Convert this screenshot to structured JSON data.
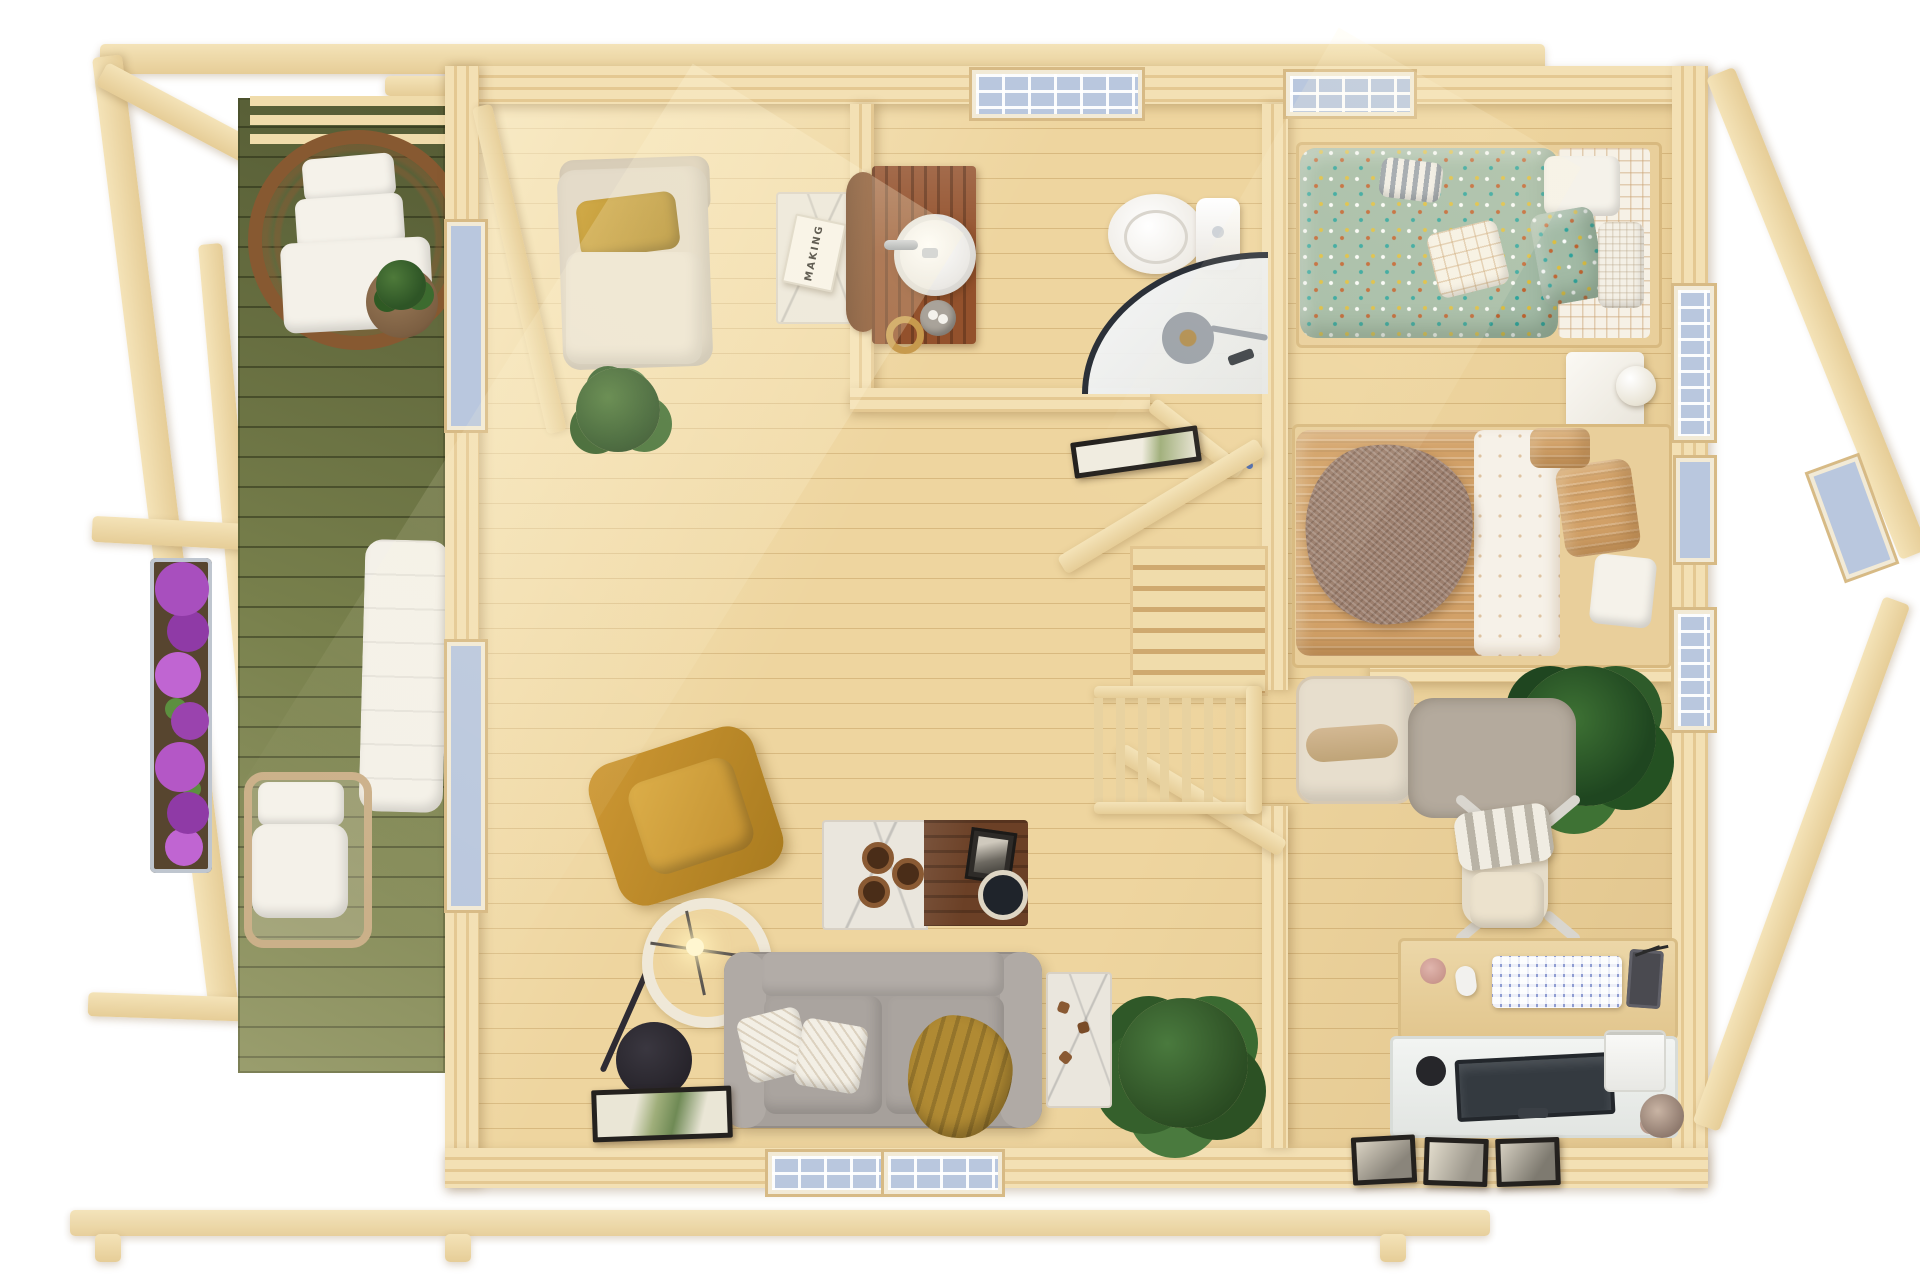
{
  "meta": {
    "title": "Log cabin with terrace — top-down 3D dollhouse floor plan render",
    "view": "top-down cutaway, roof removed",
    "floors_shown": 1
  },
  "palette": {
    "wood_beam": "#f4e3b8",
    "wood_wall": "#eed7a8",
    "floor": "#eed59f",
    "floor_line": "#dcba82",
    "deck_green": "#78804c",
    "walnut": "#6b4026",
    "vanity_wood": "#93512c",
    "sage": "#a3bba6",
    "caramel": "#d2a168",
    "mustard": "#c08a2e",
    "sofa_gray": "#a6a09b",
    "cream": "#e7decd",
    "glass_blue": "#b9c7de",
    "shower_frame": "#2b3038",
    "flower_purple": "#a84fbe",
    "plant_green": "#35602c",
    "lamp_black": "#27242b"
  },
  "rooms": {
    "terrace": {
      "label": "Terrace / pergola deck",
      "items": [
        "hanging egg chair with white cushions",
        "round side table with plant",
        "sun lounger",
        "rope armchair",
        "purple flower planter",
        "potted plant on round table",
        "green painted decking",
        "pergola beams"
      ]
    },
    "living_room": {
      "label": "Living room",
      "items": [
        "cream chaise lounge with mustard pillow",
        "white side table",
        "book",
        "indoor plant",
        "mustard swivel armchair",
        "ring floor lamp with black base",
        "gray two-seat sofa",
        "two white herringbone cushions",
        "mustard throw",
        "coffee table (marble + walnut)",
        "three wooden coasters",
        "black bowl",
        "black and white photo",
        "fiddle leaf fig plant",
        "marble console with small wood figures",
        "framed palm print leaning on wall",
        "two front windows",
        "two left-wall windows"
      ]
    },
    "bathroom": {
      "label": "Bathroom",
      "items": [
        "wooden vanity",
        "round vessel sink with faucet",
        "round wood mirror",
        "stone soap dish",
        "towel ring",
        "toilet",
        "corner shower with curved glass",
        "shower drain and hand shower",
        "gridded window"
      ]
    },
    "bedroom": {
      "label": "Bedroom",
      "items": [
        "bed with sage confetti-dot duvet",
        "gray striped pillow",
        "white waffle and check pillows",
        "sage dot pillow",
        "bed with caramel striped duvet",
        "folded white sheet",
        "brown textured throw",
        "two white nightstands",
        "two white ball table lamps",
        "top-wall window",
        "two right-wall gridded windows"
      ]
    },
    "hallway": {
      "label": "Hall / landing",
      "items": [
        "staircase treads",
        "baluster railing",
        "framed leaf print on half wall",
        "open bathroom door",
        "sloped roof braces"
      ]
    },
    "office": {
      "label": "Home office",
      "items": [
        "cream boucle bench with bolster",
        "large fern plant",
        "gray floor mat",
        "office chair with striped blanket",
        "wooden desk",
        "lavender keyboard",
        "white mouse",
        "pink coaster",
        "dark tablet",
        "pens",
        "white return desk",
        "monitor",
        "black pen cup",
        "white printer",
        "dried flowers",
        "three leaning framed prints",
        "right-wall window"
      ]
    }
  },
  "living_room_text": {
    "book_title": "MAKING"
  }
}
